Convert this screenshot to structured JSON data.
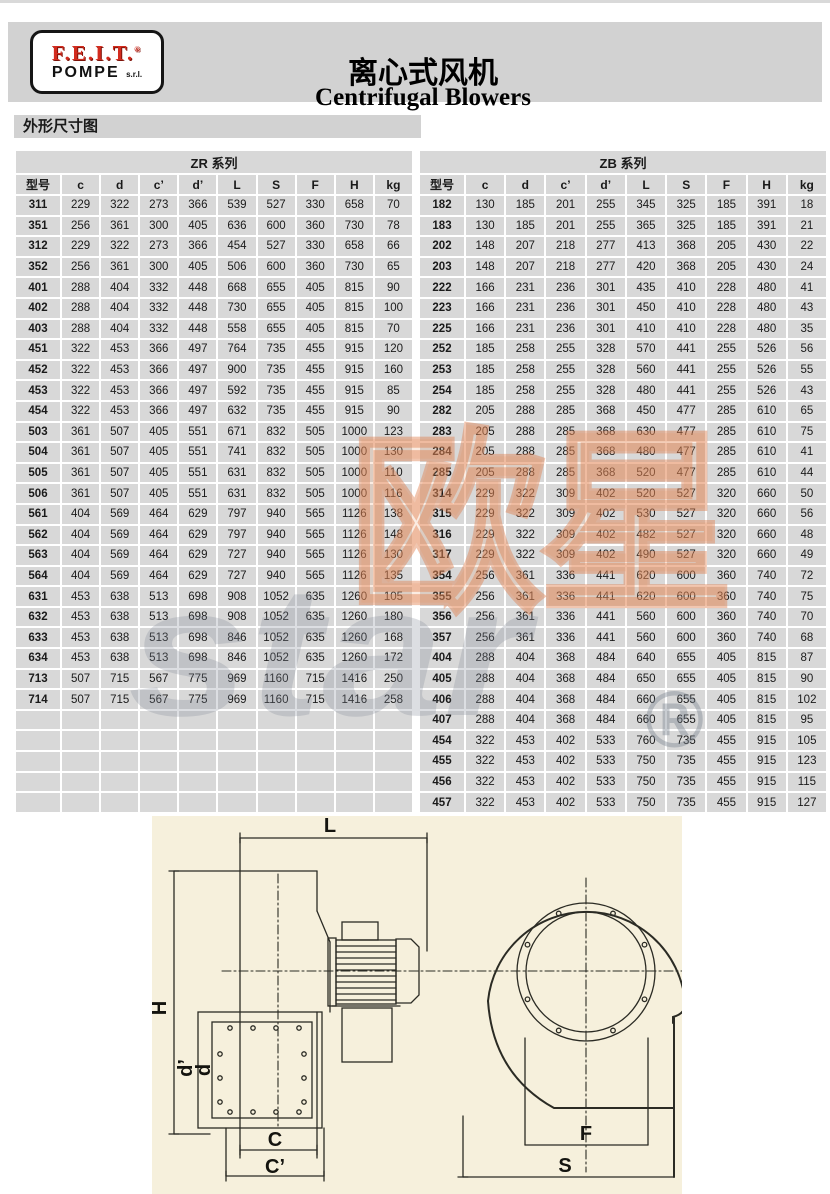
{
  "header": {
    "logo": {
      "brand": "F.E.I.T.",
      "reg": "®",
      "sub": "POMPE",
      "suffix": "s.r.l."
    },
    "title_zh": "离心式风机",
    "title_en": "Centrifugal Blowers"
  },
  "section": {
    "title": "外形尺寸图"
  },
  "tables": {
    "columns": [
      "型号",
      "c",
      "d",
      "c’",
      "d’",
      "L",
      "S",
      "F",
      "H",
      "kg"
    ],
    "zr": {
      "title": "ZR 系列",
      "empty_rows": 5,
      "rows": [
        [
          311,
          229,
          322,
          273,
          366,
          539,
          527,
          330,
          658,
          70
        ],
        [
          351,
          256,
          361,
          300,
          405,
          636,
          600,
          360,
          730,
          78
        ],
        [
          312,
          229,
          322,
          273,
          366,
          454,
          527,
          330,
          658,
          66
        ],
        [
          352,
          256,
          361,
          300,
          405,
          506,
          600,
          360,
          730,
          65
        ],
        [
          401,
          288,
          404,
          332,
          448,
          668,
          655,
          405,
          815,
          90
        ],
        [
          402,
          288,
          404,
          332,
          448,
          730,
          655,
          405,
          815,
          100
        ],
        [
          403,
          288,
          404,
          332,
          448,
          558,
          655,
          405,
          815,
          70
        ],
        [
          451,
          322,
          453,
          366,
          497,
          764,
          735,
          455,
          915,
          120
        ],
        [
          452,
          322,
          453,
          366,
          497,
          900,
          735,
          455,
          915,
          160
        ],
        [
          453,
          322,
          453,
          366,
          497,
          592,
          735,
          455,
          915,
          85
        ],
        [
          454,
          322,
          453,
          366,
          497,
          632,
          735,
          455,
          915,
          90
        ],
        [
          503,
          361,
          507,
          405,
          551,
          671,
          832,
          505,
          1000,
          123
        ],
        [
          504,
          361,
          507,
          405,
          551,
          741,
          832,
          505,
          1000,
          130
        ],
        [
          505,
          361,
          507,
          405,
          551,
          631,
          832,
          505,
          1000,
          110
        ],
        [
          506,
          361,
          507,
          405,
          551,
          631,
          832,
          505,
          1000,
          116
        ],
        [
          561,
          404,
          569,
          464,
          629,
          797,
          940,
          565,
          1126,
          138
        ],
        [
          562,
          404,
          569,
          464,
          629,
          797,
          940,
          565,
          1126,
          148
        ],
        [
          563,
          404,
          569,
          464,
          629,
          727,
          940,
          565,
          1126,
          130
        ],
        [
          564,
          404,
          569,
          464,
          629,
          727,
          940,
          565,
          1126,
          135
        ],
        [
          631,
          453,
          638,
          513,
          698,
          908,
          1052,
          635,
          1260,
          105
        ],
        [
          632,
          453,
          638,
          513,
          698,
          908,
          1052,
          635,
          1260,
          180
        ],
        [
          633,
          453,
          638,
          513,
          698,
          846,
          1052,
          635,
          1260,
          168
        ],
        [
          634,
          453,
          638,
          513,
          698,
          846,
          1052,
          635,
          1260,
          172
        ],
        [
          713,
          507,
          715,
          567,
          775,
          969,
          1160,
          715,
          1416,
          250
        ],
        [
          714,
          507,
          715,
          567,
          775,
          969,
          1160,
          715,
          1416,
          258
        ]
      ]
    },
    "zb": {
      "title": "ZB 系列",
      "empty_rows": 0,
      "rows": [
        [
          182,
          130,
          185,
          201,
          255,
          345,
          325,
          185,
          391,
          18
        ],
        [
          183,
          130,
          185,
          201,
          255,
          365,
          325,
          185,
          391,
          21
        ],
        [
          202,
          148,
          207,
          218,
          277,
          413,
          368,
          205,
          430,
          22
        ],
        [
          203,
          148,
          207,
          218,
          277,
          420,
          368,
          205,
          430,
          24
        ],
        [
          222,
          166,
          231,
          236,
          301,
          435,
          410,
          228,
          480,
          41
        ],
        [
          223,
          166,
          231,
          236,
          301,
          450,
          410,
          228,
          480,
          43
        ],
        [
          225,
          166,
          231,
          236,
          301,
          410,
          410,
          228,
          480,
          35
        ],
        [
          252,
          185,
          258,
          255,
          328,
          570,
          441,
          255,
          526,
          56
        ],
        [
          253,
          185,
          258,
          255,
          328,
          560,
          441,
          255,
          526,
          55
        ],
        [
          254,
          185,
          258,
          255,
          328,
          480,
          441,
          255,
          526,
          43
        ],
        [
          282,
          205,
          288,
          285,
          368,
          450,
          477,
          285,
          610,
          65
        ],
        [
          283,
          205,
          288,
          285,
          368,
          630,
          477,
          285,
          610,
          75
        ],
        [
          284,
          205,
          288,
          285,
          368,
          480,
          477,
          285,
          610,
          41
        ],
        [
          285,
          205,
          288,
          285,
          368,
          520,
          477,
          285,
          610,
          44
        ],
        [
          314,
          229,
          322,
          309,
          402,
          520,
          527,
          320,
          660,
          50
        ],
        [
          315,
          229,
          322,
          309,
          402,
          530,
          527,
          320,
          660,
          56
        ],
        [
          316,
          229,
          322,
          309,
          402,
          482,
          527,
          320,
          660,
          48
        ],
        [
          317,
          229,
          322,
          309,
          402,
          490,
          527,
          320,
          660,
          49
        ],
        [
          354,
          256,
          361,
          336,
          441,
          620,
          600,
          360,
          740,
          72
        ],
        [
          355,
          256,
          361,
          336,
          441,
          620,
          600,
          360,
          740,
          75
        ],
        [
          356,
          256,
          361,
          336,
          441,
          560,
          600,
          360,
          740,
          70
        ],
        [
          357,
          256,
          361,
          336,
          441,
          560,
          600,
          360,
          740,
          68
        ],
        [
          404,
          288,
          404,
          368,
          484,
          640,
          655,
          405,
          815,
          87
        ],
        [
          405,
          288,
          404,
          368,
          484,
          650,
          655,
          405,
          815,
          90
        ],
        [
          406,
          288,
          404,
          368,
          484,
          660,
          655,
          405,
          815,
          102
        ],
        [
          407,
          288,
          404,
          368,
          484,
          660,
          655,
          405,
          815,
          95
        ],
        [
          454,
          322,
          453,
          402,
          533,
          760,
          735,
          455,
          915,
          105
        ],
        [
          455,
          322,
          453,
          402,
          533,
          750,
          735,
          455,
          915,
          123
        ],
        [
          456,
          322,
          453,
          402,
          533,
          750,
          735,
          455,
          915,
          115
        ],
        [
          457,
          322,
          453,
          402,
          533,
          750,
          735,
          455,
          915,
          127
        ]
      ]
    }
  },
  "watermark": {
    "zh": "欧星",
    "en": "star",
    "reg": "®"
  },
  "diagram": {
    "labels": {
      "L": "L",
      "H": "H",
      "d_prime": "d’",
      "d": "d",
      "C": "C",
      "C_prime": "C’",
      "F": "F",
      "S": "S"
    }
  }
}
